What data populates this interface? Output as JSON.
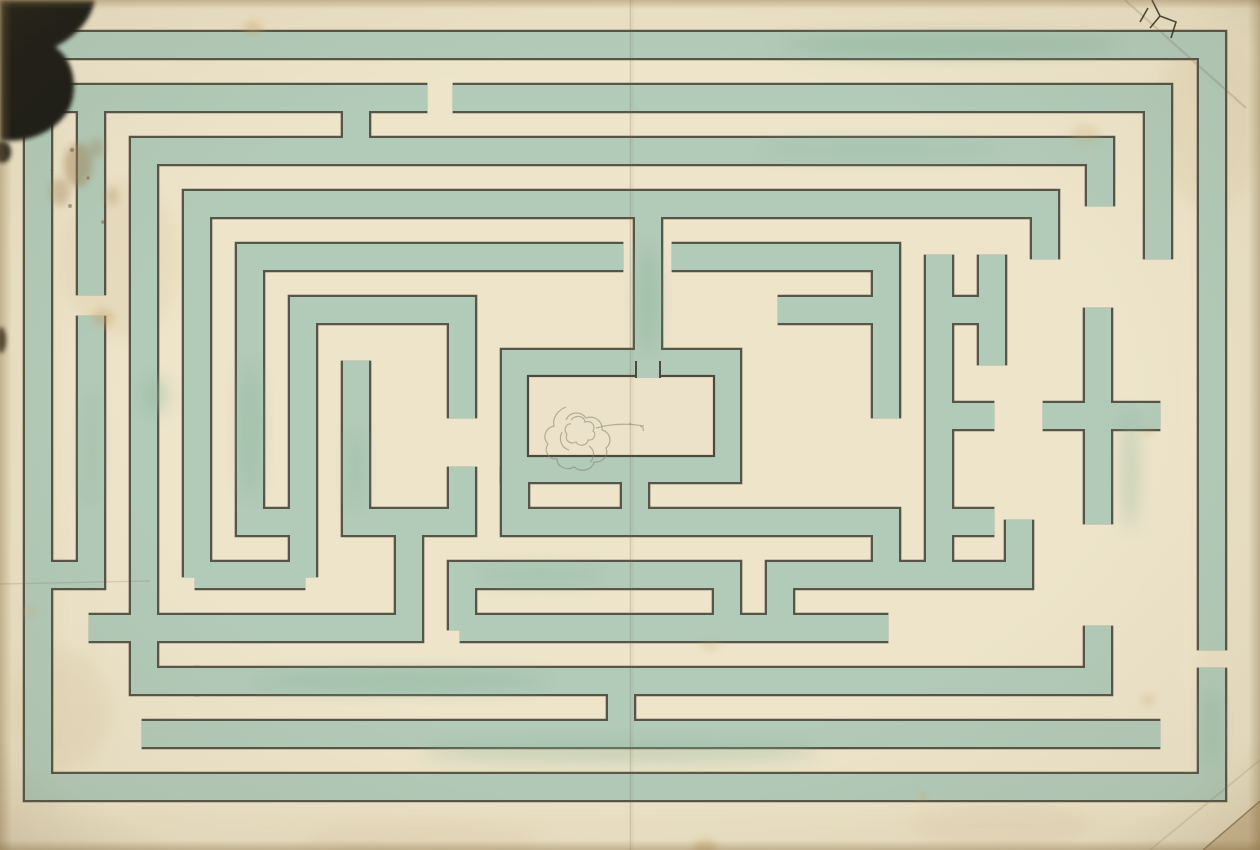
{
  "artwork": {
    "kind": "watercolor-maze-plan",
    "canvas": {
      "w": 1260,
      "h": 850
    },
    "style": {
      "paper": "#eae0c4",
      "paper_light": "#efe6cd",
      "paper_margin": "#e2d4b3",
      "edge_shade": "#8a6f42",
      "hedge_green": "#b2cab8",
      "hedge_green_deep": "#8fb79b",
      "ink_line": "#4a493c",
      "blob_black": "#1a1a17",
      "pencil": "#85806e",
      "stain_brown": "#9b7d4e",
      "stain_yellow": "#caa369",
      "cut_backing": "#d0bd98",
      "room_fill": "#ece2c9"
    },
    "maze": {
      "band_green_width": 26,
      "band_outline_width": 30.6,
      "end_extension": 2.4,
      "bands": [
        [
          [
            1212,
            648
          ],
          [
            1212,
            45
          ],
          [
            38,
            45
          ],
          [
            38,
            787
          ],
          [
            1212,
            787
          ],
          [
            1212,
            670
          ]
        ],
        [
          [
            60,
            98
          ],
          [
            425,
            98
          ]
        ],
        [
          [
            455,
            98
          ],
          [
            1158,
            98
          ],
          [
            1158,
            257
          ]
        ],
        [
          [
            356,
            98
          ],
          [
            356,
            151
          ]
        ],
        [
          [
            1100,
            204
          ],
          [
            1100,
            151
          ],
          [
            144,
            151
          ],
          [
            144,
            681
          ],
          [
            197,
            681
          ]
        ],
        [
          [
            197,
            575
          ],
          [
            197,
            204
          ],
          [
            1045,
            204
          ],
          [
            1045,
            257
          ]
        ],
        [
          [
            621,
            257
          ],
          [
            250,
            257
          ],
          [
            250,
            522
          ],
          [
            303,
            522
          ]
        ],
        [
          [
            462,
            416
          ],
          [
            462,
            310
          ],
          [
            303,
            310
          ],
          [
            303,
            575
          ]
        ],
        [
          [
            648,
            204
          ],
          [
            648,
            363
          ]
        ],
        [
          [
            515,
            363
          ],
          [
            727,
            363
          ],
          [
            727,
            469
          ],
          [
            515,
            469
          ],
          [
            515,
            363
          ]
        ],
        [
          [
            635,
            469
          ],
          [
            635,
            522
          ]
        ],
        [
          [
            515,
            469
          ],
          [
            515,
            522
          ],
          [
            886,
            522
          ],
          [
            886,
            575
          ]
        ],
        [
          [
            356,
            363
          ],
          [
            356,
            522
          ],
          [
            462,
            522
          ],
          [
            462,
            469
          ]
        ],
        [
          [
            91,
            98
          ],
          [
            91,
            293
          ]
        ],
        [
          [
            91,
            318
          ],
          [
            91,
            575
          ],
          [
            38,
            575
          ]
        ],
        [
          [
            91,
            628
          ],
          [
            409,
            628
          ],
          [
            409,
            522
          ]
        ],
        [
          [
            197,
            575
          ],
          [
            303,
            575
          ]
        ],
        [
          [
            462,
            628
          ],
          [
            462,
            575
          ],
          [
            727,
            575
          ],
          [
            727,
            628
          ]
        ],
        [
          [
            780,
            628
          ],
          [
            780,
            575
          ],
          [
            1019,
            575
          ],
          [
            1019,
            522
          ]
        ],
        [
          [
            197,
            681
          ],
          [
            1098,
            681
          ],
          [
            1098,
            628
          ]
        ],
        [
          [
            144,
            734
          ],
          [
            1158,
            734
          ]
        ],
        [
          [
            621,
            681
          ],
          [
            621,
            734
          ]
        ],
        [
          [
            674,
            257
          ],
          [
            886,
            257
          ],
          [
            886,
            416
          ]
        ],
        [
          [
            780,
            310
          ],
          [
            886,
            310
          ]
        ],
        [
          [
            939,
            257
          ],
          [
            939,
            575
          ]
        ],
        [
          [
            939,
            310
          ],
          [
            992,
            310
          ]
        ],
        [
          [
            939,
            416
          ],
          [
            992,
            416
          ]
        ],
        [
          [
            939,
            522
          ],
          [
            992,
            522
          ]
        ],
        [
          [
            1098,
            310
          ],
          [
            1098,
            522
          ]
        ],
        [
          [
            1045,
            416
          ],
          [
            1158,
            416
          ]
        ],
        [
          [
            992,
            257
          ],
          [
            992,
            363
          ]
        ],
        [
          [
            462,
            628
          ],
          [
            886,
            628
          ]
        ]
      ]
    },
    "center_room": {
      "x": 528,
      "y": 376,
      "w": 186,
      "h": 80,
      "plug": {
        "x": 636,
        "y": 361,
        "w": 24,
        "h": 17
      }
    },
    "flower_sketch": {
      "paths": [
        "M566,407 c-8,3 -14,11 -12,19 c-9,2 -12,12 -6,18 c-5,7 1,16 9,15 c0,8 10,12 17,8 c8,6 18,3 20,-5 c9,1 15,-7 12,-14 c7,-6 4,-16 -4,-18 c1,-9 -8,-15 -16,-12 c-5,-7 -16,-7 -20,2",
        "M571,420 c5,-6 13,-4 14,2 c6,-2 11,3 8,9 c4,3 1,10 -5,9 c-1,6 -9,7 -12,2 c-6,3 -12,-2 -9,-8 c-4,-4 -1,-11 4,-10",
        "M562,432 c-4,8 0,16 7,18 M589,446 c6,4 6,12 1,16",
        "M596,428 c14,-4 30,-5 48,-2 M640,426 c3,1 4,3 3,5"
      ],
      "dot": {
        "cx": 630,
        "cy": 424,
        "r": 1.4
      }
    },
    "green_patches": [
      {
        "cx": 950,
        "cy": 45,
        "rx": 170,
        "ry": 11,
        "o": 0.5
      },
      {
        "cx": 648,
        "cy": 300,
        "rx": 11,
        "ry": 55,
        "o": 0.45
      },
      {
        "cx": 400,
        "cy": 681,
        "rx": 150,
        "ry": 11,
        "o": 0.4
      },
      {
        "cx": 250,
        "cy": 430,
        "rx": 11,
        "ry": 70,
        "o": 0.4
      },
      {
        "cx": 620,
        "cy": 752,
        "rx": 200,
        "ry": 12,
        "o": 0.35
      },
      {
        "cx": 1130,
        "cy": 470,
        "rx": 10,
        "ry": 60,
        "o": 0.35
      },
      {
        "cx": 540,
        "cy": 575,
        "rx": 60,
        "ry": 10,
        "o": 0.3
      },
      {
        "cx": 880,
        "cy": 150,
        "rx": 120,
        "ry": 10,
        "o": 0.3
      },
      {
        "cx": 91,
        "cy": 450,
        "rx": 9,
        "ry": 60,
        "o": 0.3
      },
      {
        "cx": 1212,
        "cy": 730,
        "rx": 10,
        "ry": 40,
        "o": 0.35
      },
      {
        "cx": 356,
        "cy": 470,
        "rx": 9,
        "ry": 40,
        "o": 0.35
      },
      {
        "cx": 155,
        "cy": 395,
        "rx": 12,
        "ry": 18,
        "o": 0.45
      }
    ],
    "paper_blemishes": {
      "blob_main": "M0,0 L95,0 C90,24 72,38 55,47 C72,58 79,84 70,107 C58,132 26,144 0,140 Z",
      "blob_spots": [
        {
          "cx": 2,
          "cy": 152,
          "rx": 9,
          "ry": 11,
          "o": 0.95
        },
        {
          "cx": 1,
          "cy": 340,
          "rx": 5,
          "ry": 13,
          "o": 0.85
        }
      ],
      "brown_smudges": [
        {
          "cx": 78,
          "cy": 165,
          "rx": 14,
          "ry": 22,
          "o": 0.45
        },
        {
          "cx": 60,
          "cy": 192,
          "rx": 10,
          "ry": 14,
          "o": 0.35
        },
        {
          "cx": 96,
          "cy": 148,
          "rx": 8,
          "ry": 10,
          "o": 0.3
        },
        {
          "cx": 112,
          "cy": 196,
          "rx": 6,
          "ry": 9,
          "o": 0.28
        }
      ],
      "speckles": [
        {
          "cx": 72,
          "cy": 150,
          "r": 2.2
        },
        {
          "cx": 88,
          "cy": 178,
          "r": 1.6
        },
        {
          "cx": 70,
          "cy": 206,
          "r": 2.0
        },
        {
          "cx": 52,
          "cy": 170,
          "r": 1.5
        },
        {
          "cx": 103,
          "cy": 222,
          "r": 1.8
        }
      ],
      "yellow_stains": [
        {
          "cx": 103,
          "cy": 318,
          "rx": 11,
          "ry": 9,
          "o": 0.4
        },
        {
          "cx": 253,
          "cy": 28,
          "rx": 10,
          "ry": 7,
          "o": 0.35
        },
        {
          "cx": 1085,
          "cy": 135,
          "rx": 14,
          "ry": 10,
          "o": 0.22
        },
        {
          "cx": 30,
          "cy": 612,
          "rx": 7,
          "ry": 5,
          "o": 0.3
        },
        {
          "cx": 705,
          "cy": 848,
          "rx": 12,
          "ry": 8,
          "o": 0.45
        },
        {
          "cx": 922,
          "cy": 796,
          "rx": 6,
          "ry": 4,
          "o": 0.3
        },
        {
          "cx": 1148,
          "cy": 700,
          "rx": 6,
          "ry": 5,
          "o": 0.35
        },
        {
          "cx": 1148,
          "cy": 432,
          "rx": 5,
          "ry": 4,
          "o": 0.28
        },
        {
          "cx": 710,
          "cy": 645,
          "rx": 9,
          "ry": 6,
          "o": 0.2
        }
      ],
      "creases": [
        {
          "x1": 630.5,
          "y1": 0,
          "x2": 630.5,
          "y2": 850,
          "w": 1.6,
          "o": 0.22
        },
        {
          "x1": 633,
          "y1": 0,
          "x2": 633,
          "y2": 850,
          "w": 1.0,
          "o": 0.1
        },
        {
          "x1": 0,
          "y1": 584,
          "x2": 150,
          "y2": 581,
          "w": 1.4,
          "o": 0.18
        },
        {
          "x1": 1125,
          "y1": 0,
          "x2": 1246,
          "y2": 108,
          "w": 2.2,
          "o": 0.2
        },
        {
          "x1": 1150,
          "y1": 850,
          "x2": 1260,
          "y2": 760,
          "w": 2.0,
          "o": 0.15
        }
      ],
      "crack_path": "M1152,0 L1160,16 L1150,28 M1160,16 L1176,22 L1171,38 M1148,8 L1140,22",
      "corner_cut": {
        "poly": "1203,850 1260,801 1260,850",
        "edge": {
          "x1": 1203,
          "y1": 850,
          "x2": 1260,
          "y2": 801
        }
      }
    }
  }
}
